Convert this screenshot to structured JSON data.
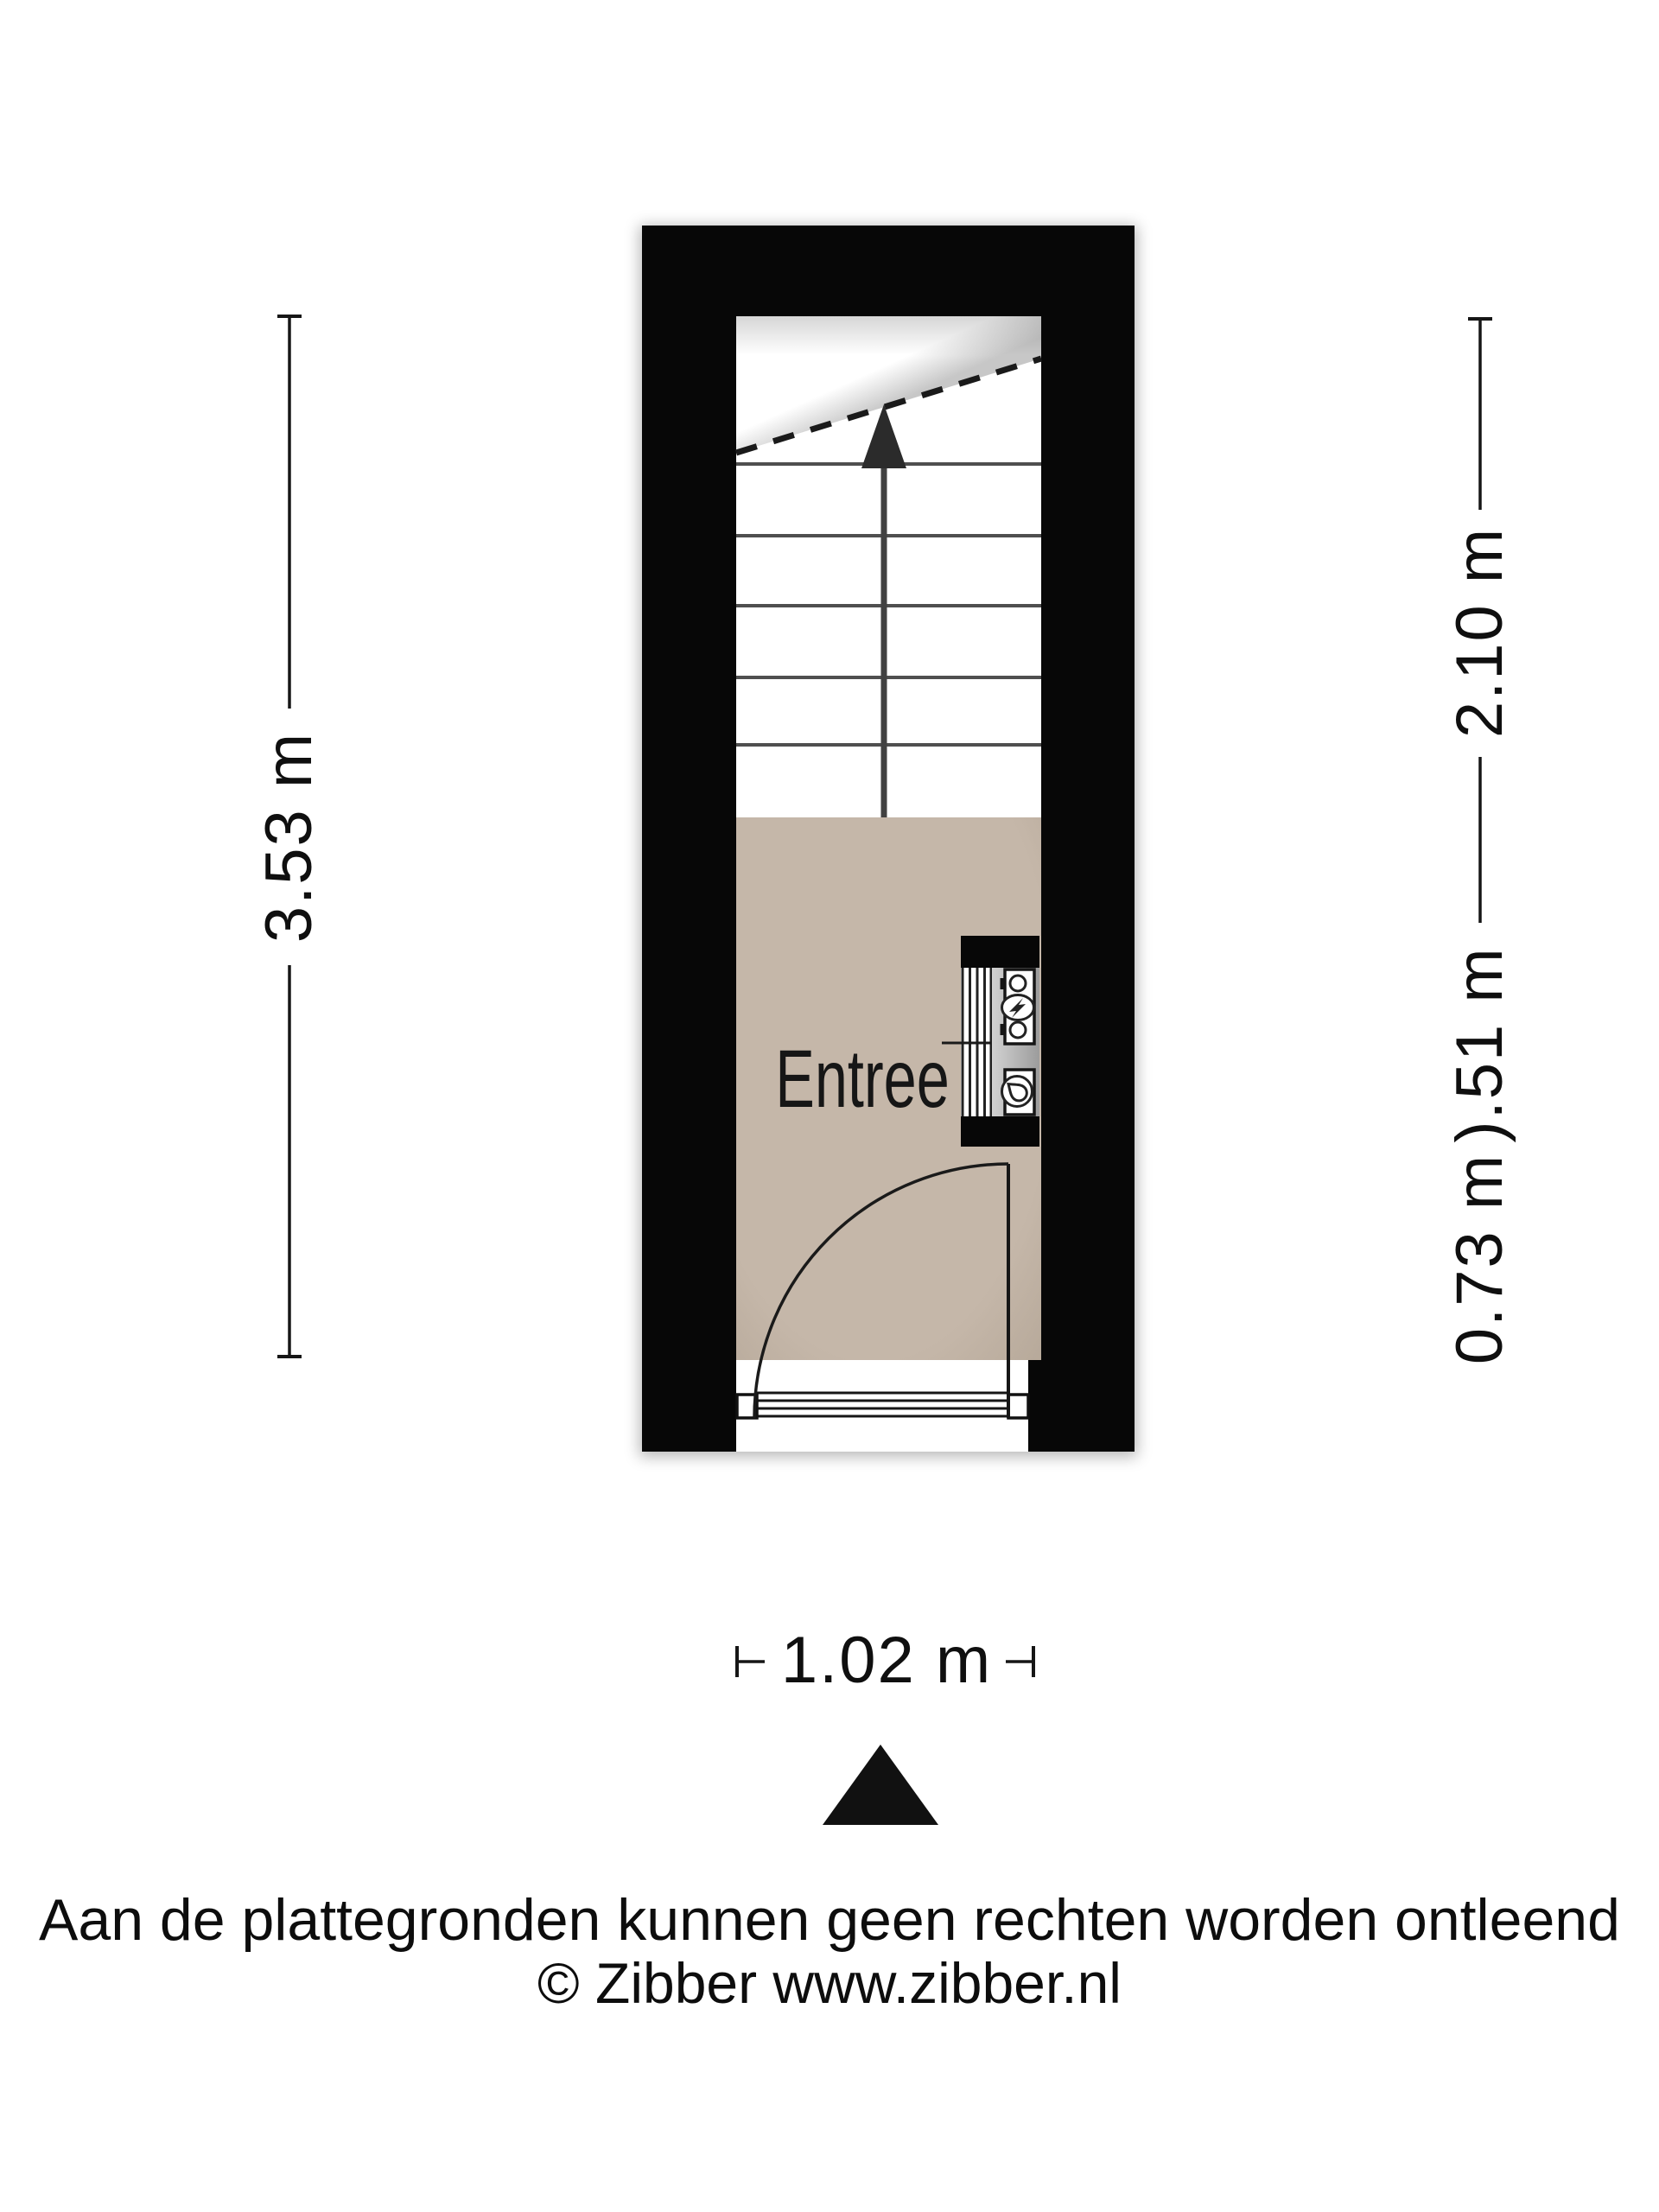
{
  "floorplan": {
    "room_label": "Entree",
    "dimensions": {
      "left": "3.53 m",
      "right_top": "2.10 m",
      "right_middle": ").51 m",
      "right_bottom": "0.73 m",
      "bottom": "1.02 m"
    },
    "colors": {
      "wall": "#070707",
      "floor": "#c5b7a9",
      "floor_edge": "#b8aa9b",
      "stairs": "#ffffff",
      "line": "#1a1a1a",
      "step_line": "#4f4f4f",
      "arrow": "#2b2b2b",
      "panel_light": "#d2d2d2",
      "panel_dark": "#9c9c9c",
      "compass": "#111111"
    },
    "icons": {
      "stairs_direction": "up-arrow",
      "stairs_cut": "dashed-diagonal-cut-line",
      "electricity_meter": "circle-with-lightning-bolt",
      "water_meter": "circle-with-droplet",
      "radiator": "striped-band",
      "door": "quarter-circle-door-swing"
    }
  },
  "compass": {
    "icon": "north-arrow-triangle"
  },
  "footer": {
    "disclaimer": "Aan de plattegronden kunnen geen rechten worden ontleend",
    "copyright": "© Zibber www.zibber.nl"
  }
}
